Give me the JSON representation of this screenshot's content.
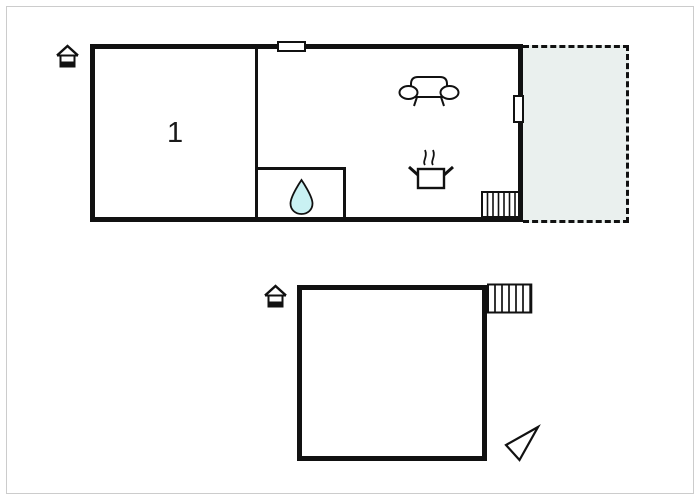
{
  "diagram": {
    "type": "floor-plan"
  },
  "colors": {
    "wall": "#111111",
    "terrace_fill": "#eaf0ee",
    "water_drop_fill": "#c9f1f3",
    "frame": "#cccccc",
    "background": "#ffffff"
  },
  "floor1": {
    "room1": {
      "label": "1"
    },
    "icons": [
      {
        "name": "house-entrance-icon"
      },
      {
        "name": "sofa-icon"
      },
      {
        "name": "cooking-pot-icon"
      },
      {
        "name": "water-drop-icon"
      }
    ],
    "features": [
      "top-window",
      "right-window",
      "interior-stairs",
      "dashed-terrace"
    ]
  },
  "floor2": {
    "icons": [
      {
        "name": "house-entrance-icon"
      },
      {
        "name": "north-arrow-icon"
      }
    ],
    "features": [
      "exterior-stairs"
    ]
  }
}
